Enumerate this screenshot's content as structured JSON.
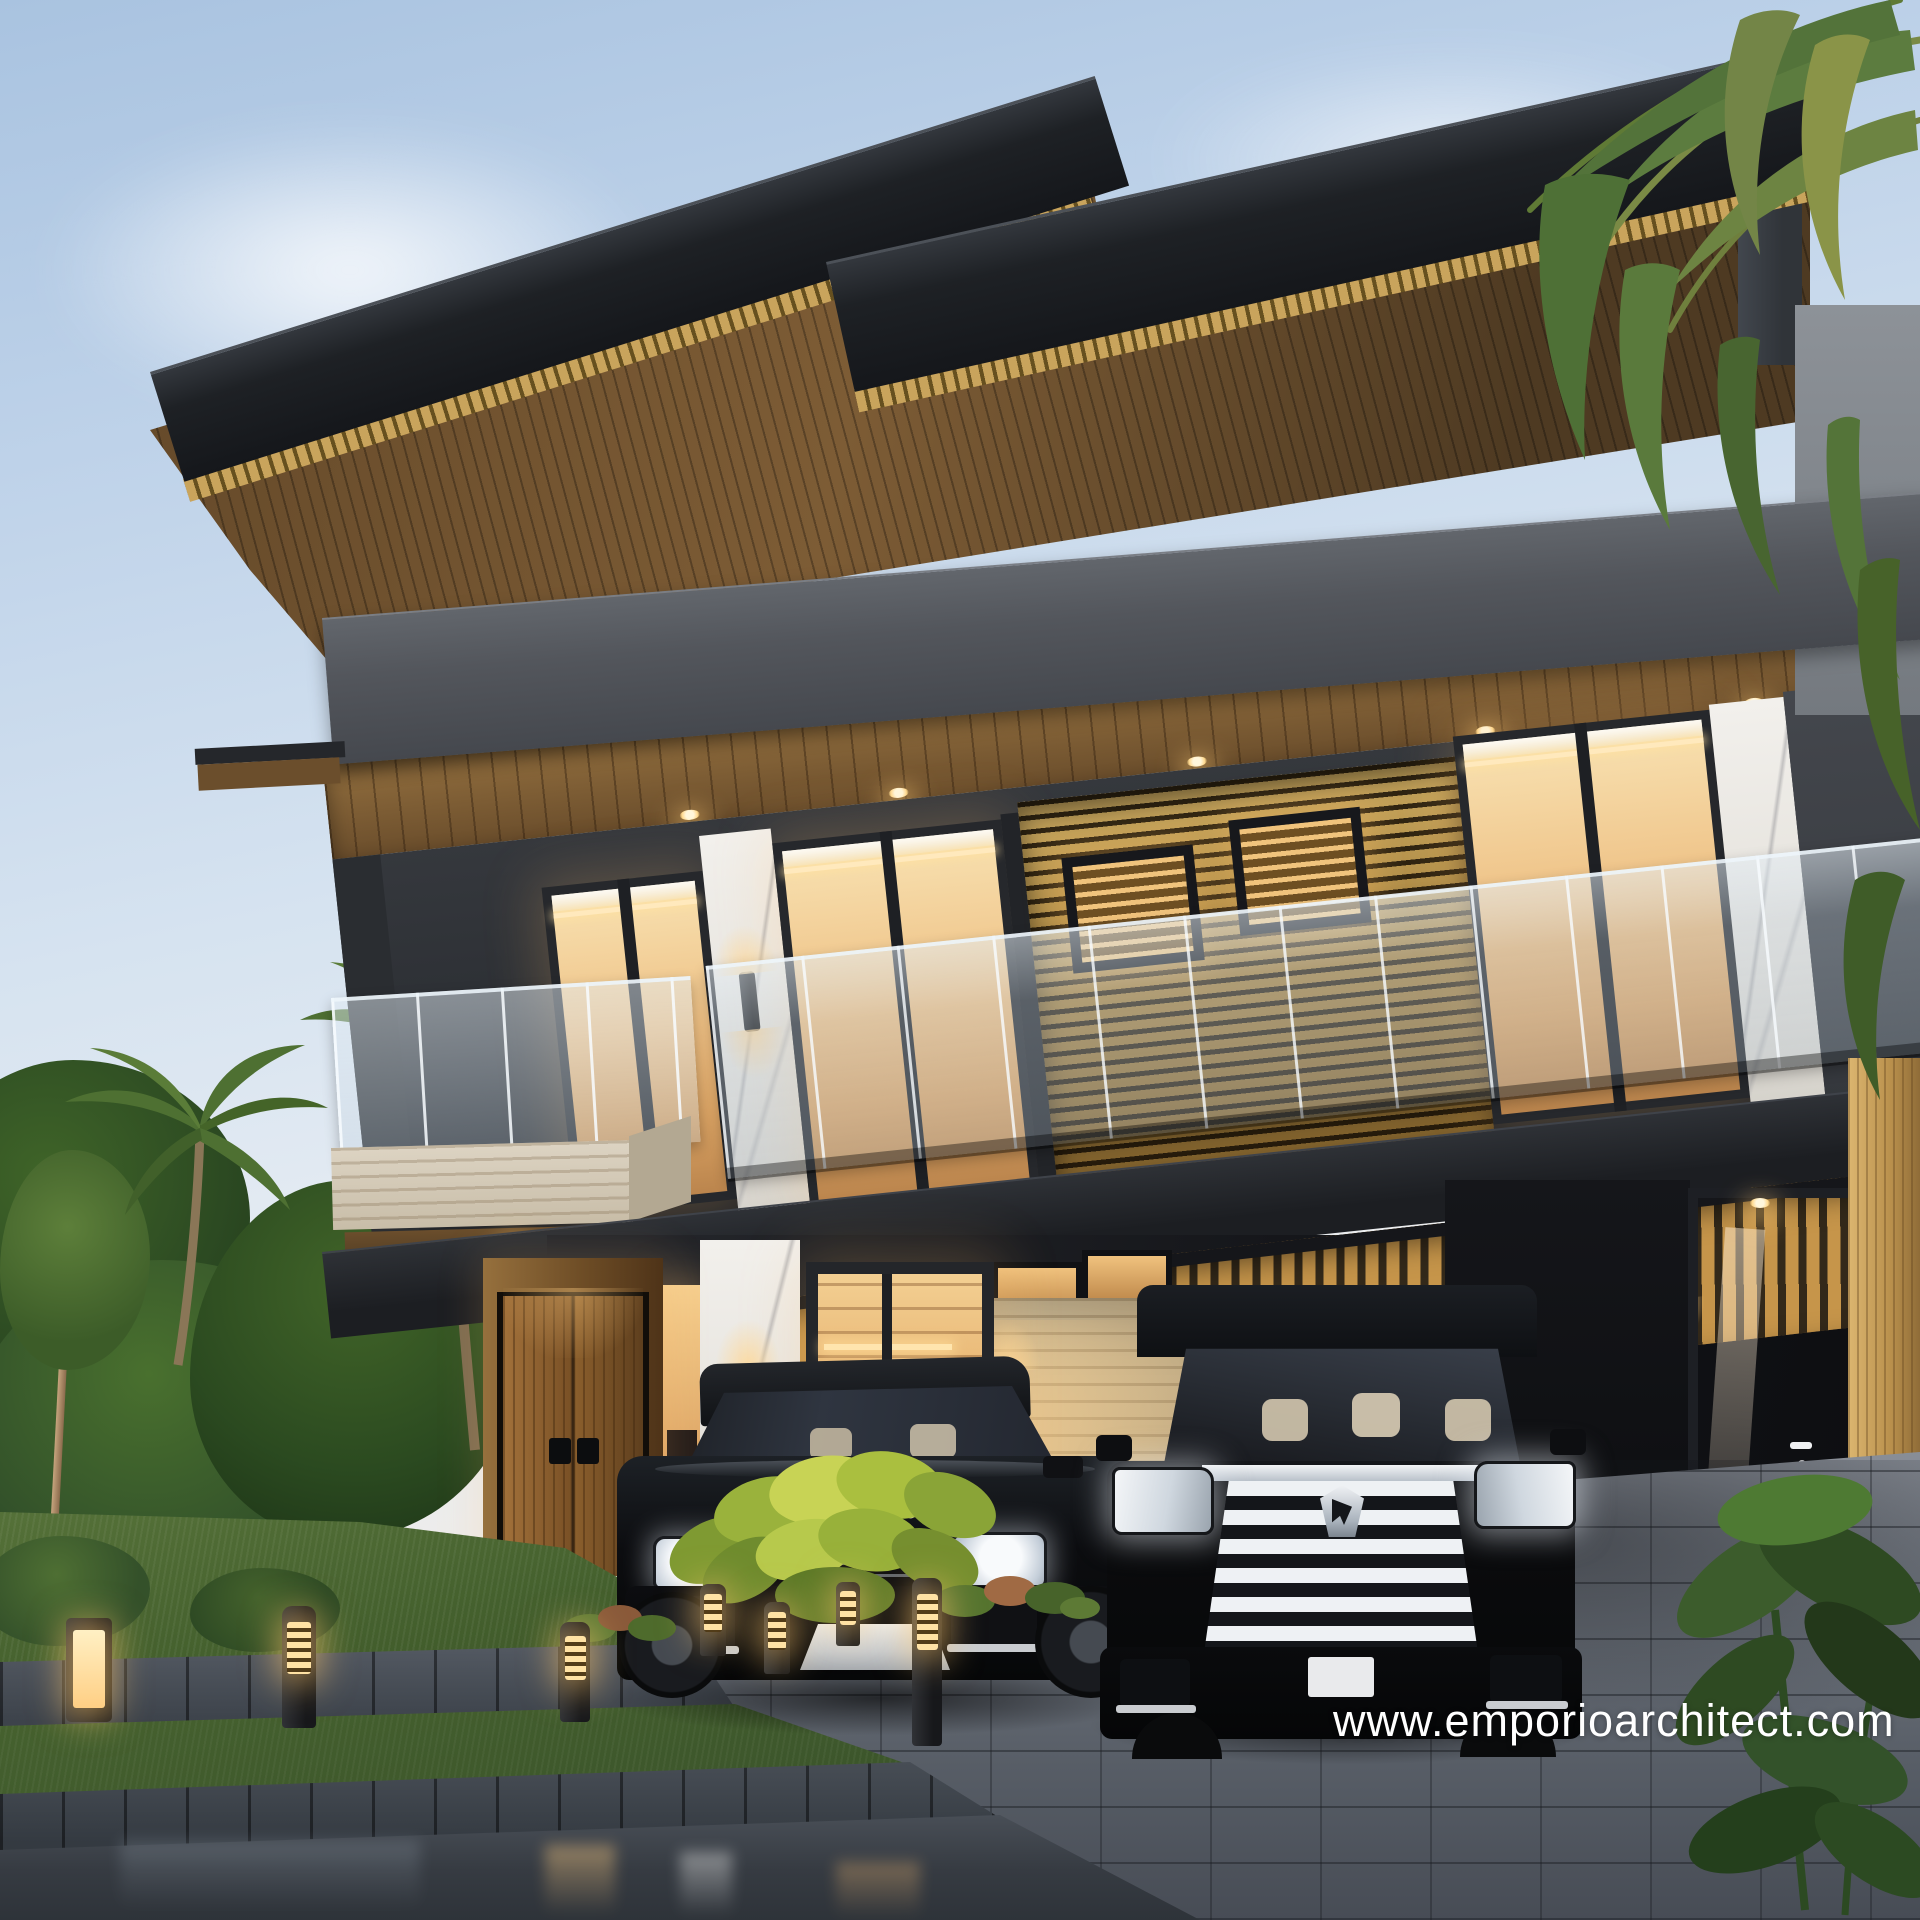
{
  "scene": {
    "description": "Dusk photorealistic exterior rendering of a modern two-storey tropical villa with stacked cantilevered dark roofs, wood-slat soffits, golden louver screens, glass balconies, a double carport with two black luxury cars, landscaped lawn, planters and bollard lights",
    "time_of_day": "dusk"
  },
  "watermark": {
    "text": "www.emporioarchitect.com",
    "color": "#ffffff"
  },
  "vehicles": {
    "suv": {
      "badge_text": "RANGE ROVER",
      "body_color": "#0d0e10"
    },
    "mpv": {
      "body_color": "#0b0c0e",
      "grille_color": "#e8ecf0"
    }
  },
  "palette": {
    "sky_top": "#a9c3e0",
    "sky_low": "#f1ece5",
    "roof_dark": "#1e2125",
    "fascia_gold": "#c9a45c",
    "soffit_wood": "#7d5c35",
    "wall_charcoal": "#2a2d32",
    "parapet_grey": "#53565c",
    "louver_gold": "#a5813e",
    "window_warm": "#eec084",
    "glass_rail": "#c6d5e2",
    "marble_white": "#efede9",
    "travertine": "#c4ad85",
    "door_wood": "#8a5e2c",
    "pergola_wood": "#c6954a",
    "paver_grey": "#70767f",
    "asphalt_wet": "#363b42",
    "lawn_green": "#45612e",
    "foliage_green": "#3a5c2d",
    "bollard_glow": "#ffc97e",
    "chrome": "#e8ecf0"
  }
}
